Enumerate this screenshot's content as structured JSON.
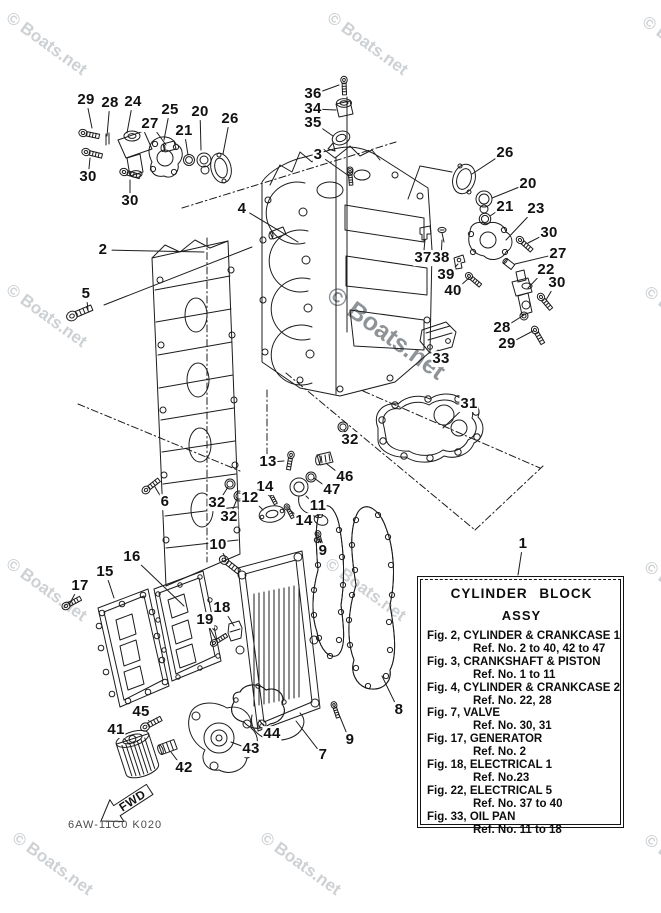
{
  "page": {
    "background": "#ffffff",
    "ink": "#1c1c1c"
  },
  "watermark": {
    "text": "© Boats.net",
    "light_color": "#cdd1d4",
    "dark_color": "#8e9397",
    "angle_deg": 36,
    "tiles": [
      {
        "x": 14,
        "y": 8,
        "size": 17,
        "tone": "light"
      },
      {
        "x": 335,
        "y": 8,
        "size": 17,
        "tone": "light"
      },
      {
        "x": 650,
        "y": 12,
        "size": 17,
        "tone": "light"
      },
      {
        "x": 14,
        "y": 280,
        "size": 17,
        "tone": "light"
      },
      {
        "x": 338,
        "y": 281,
        "size": 25,
        "tone": "dark"
      },
      {
        "x": 652,
        "y": 282,
        "size": 17,
        "tone": "light"
      },
      {
        "x": 14,
        "y": 554,
        "size": 17,
        "tone": "light"
      },
      {
        "x": 333,
        "y": 554,
        "size": 17,
        "tone": "light"
      },
      {
        "x": 652,
        "y": 557,
        "size": 17,
        "tone": "light"
      },
      {
        "x": 20,
        "y": 828,
        "size": 17,
        "tone": "light"
      },
      {
        "x": 268,
        "y": 828,
        "size": 17,
        "tone": "light"
      },
      {
        "x": 652,
        "y": 830,
        "size": 17,
        "tone": "light"
      }
    ]
  },
  "info_box": {
    "ref_number": "1",
    "title_line1": "CYLINDER BLOCK",
    "title_line2": "ASSY",
    "rows": [
      {
        "fig": "Fig. 2, CYLINDER & CRANKCASE 1",
        "ref": "Ref. No. 2 to 40, 42 to 47"
      },
      {
        "fig": "Fig. 3, CRANKSHAFT & PISTON",
        "ref": "Ref. No. 1 to 11"
      },
      {
        "fig": "Fig. 4, CYLINDER & CRANKCASE 2",
        "ref": "Ref. No. 22, 28"
      },
      {
        "fig": "Fig. 7, VALVE",
        "ref": "Ref. No. 30, 31"
      },
      {
        "fig": "Fig. 17, GENERATOR",
        "ref": "Ref. No. 2"
      },
      {
        "fig": "Fig. 18, ELECTRICAL 1",
        "ref": "Ref. No.23"
      },
      {
        "fig": "Fig. 22, ELECTRICAL 5",
        "ref": "Ref. No. 37 to 40"
      },
      {
        "fig": "Fig. 33, OIL PAN",
        "ref": "Ref. No. 11 to 18"
      }
    ]
  },
  "footer": {
    "drawing_code": "6AW-11C0 K020",
    "fwd_label": "FWD"
  },
  "callouts": [
    {
      "n": "29",
      "x": 86,
      "y": 100,
      "tx": 92,
      "ty": 128
    },
    {
      "n": "28",
      "x": 110,
      "y": 103,
      "tx": 107,
      "ty": 136
    },
    {
      "n": "24",
      "x": 133,
      "y": 102,
      "tx": 127,
      "ty": 133
    },
    {
      "n": "25",
      "x": 170,
      "y": 110,
      "tx": 164,
      "ty": 140
    },
    {
      "n": "27",
      "x": 150,
      "y": 124,
      "tx": 166,
      "ty": 145
    },
    {
      "n": "20",
      "x": 200,
      "y": 112,
      "tx": 201,
      "ty": 150
    },
    {
      "n": "21",
      "x": 184,
      "y": 131,
      "tx": 188,
      "ty": 155
    },
    {
      "n": "26",
      "x": 230,
      "y": 119,
      "tx": 223,
      "ty": 154
    },
    {
      "n": "30",
      "x": 88,
      "y": 177,
      "tx": 90,
      "ty": 158
    },
    {
      "n": "30",
      "x": 130,
      "y": 201,
      "tx": 130,
      "ty": 180
    },
    {
      "n": "2",
      "x": 103,
      "y": 250,
      "tx": 204,
      "ty": 252
    },
    {
      "n": "4",
      "x": 242,
      "y": 209,
      "tx": 298,
      "ty": 242
    },
    {
      "n": "5",
      "x": 86,
      "y": 294,
      "tx": 88,
      "ty": 310
    },
    {
      "n": "36",
      "x": 313,
      "y": 94,
      "tx": 339,
      "ty": 85
    },
    {
      "n": "34",
      "x": 313,
      "y": 109,
      "tx": 336,
      "ty": 110
    },
    {
      "n": "35",
      "x": 313,
      "y": 123,
      "tx": 333,
      "ty": 136
    },
    {
      "n": "3",
      "x": 318,
      "y": 155,
      "tx": 349,
      "ty": 176
    },
    {
      "n": "26",
      "x": 505,
      "y": 153,
      "tx": 472,
      "ty": 174
    },
    {
      "n": "20",
      "x": 528,
      "y": 184,
      "tx": 492,
      "ty": 198
    },
    {
      "n": "21",
      "x": 505,
      "y": 207,
      "tx": 490,
      "ty": 216
    },
    {
      "n": "23",
      "x": 536,
      "y": 209,
      "tx": 506,
      "ty": 240
    },
    {
      "n": "30",
      "x": 549,
      "y": 233,
      "tx": 528,
      "ty": 243
    },
    {
      "n": "27",
      "x": 558,
      "y": 254,
      "tx": 515,
      "ty": 264
    },
    {
      "n": "22",
      "x": 546,
      "y": 270,
      "tx": 528,
      "ty": 288
    },
    {
      "n": "30",
      "x": 557,
      "y": 283,
      "tx": 546,
      "ty": 300
    },
    {
      "n": "37",
      "x": 423,
      "y": 258,
      "tx": 425,
      "ty": 240
    },
    {
      "n": "38",
      "x": 441,
      "y": 258,
      "tx": 442,
      "ty": 240
    },
    {
      "n": "39",
      "x": 446,
      "y": 275,
      "tx": 458,
      "ty": 264
    },
    {
      "n": "40",
      "x": 453,
      "y": 291,
      "tx": 469,
      "ty": 278
    },
    {
      "n": "28",
      "x": 502,
      "y": 328,
      "tx": 524,
      "ty": 315
    },
    {
      "n": "29",
      "x": 507,
      "y": 344,
      "tx": 533,
      "ty": 331
    },
    {
      "n": "33",
      "x": 441,
      "y": 359,
      "tx": 438,
      "ty": 350
    },
    {
      "n": "31",
      "x": 469,
      "y": 404,
      "tx": 443,
      "ty": 428
    },
    {
      "n": "32",
      "x": 350,
      "y": 440,
      "tx": 344,
      "ty": 430
    },
    {
      "n": "13",
      "x": 268,
      "y": 462,
      "tx": 284,
      "ty": 461
    },
    {
      "n": "46",
      "x": 345,
      "y": 477,
      "tx": 327,
      "ty": 464
    },
    {
      "n": "47",
      "x": 332,
      "y": 490,
      "tx": 314,
      "ty": 478
    },
    {
      "n": "11",
      "x": 318,
      "y": 506,
      "tx": 306,
      "ty": 496
    },
    {
      "n": "14",
      "x": 265,
      "y": 487,
      "tx": 270,
      "ty": 494
    },
    {
      "n": "12",
      "x": 250,
      "y": 498,
      "tx": 263,
      "ty": 510
    },
    {
      "n": "32",
      "x": 217,
      "y": 503,
      "tx": 228,
      "ty": 487
    },
    {
      "n": "32",
      "x": 229,
      "y": 517,
      "tx": 237,
      "ty": 499
    },
    {
      "n": "14",
      "x": 304,
      "y": 521,
      "tx": 290,
      "ty": 510
    },
    {
      "n": "10",
      "x": 218,
      "y": 545,
      "tx": 226,
      "ty": 559
    },
    {
      "n": "9",
      "x": 323,
      "y": 551,
      "tx": 320,
      "ty": 540
    },
    {
      "n": "16",
      "x": 132,
      "y": 557,
      "tx": 184,
      "ty": 606
    },
    {
      "n": "15",
      "x": 105,
      "y": 572,
      "tx": 114,
      "ty": 598
    },
    {
      "n": "17",
      "x": 80,
      "y": 586,
      "tx": 70,
      "ty": 603
    },
    {
      "n": "18",
      "x": 222,
      "y": 608,
      "tx": 234,
      "ty": 626
    },
    {
      "n": "19",
      "x": 205,
      "y": 620,
      "tx": 216,
      "ty": 640
    },
    {
      "n": "6",
      "x": 165,
      "y": 502,
      "tx": 155,
      "ty": 487
    },
    {
      "n": "8",
      "x": 399,
      "y": 710,
      "tx": 382,
      "ty": 676
    },
    {
      "n": "9",
      "x": 350,
      "y": 740,
      "tx": 338,
      "ty": 712
    },
    {
      "n": "7",
      "x": 323,
      "y": 755,
      "tx": 296,
      "ty": 721
    },
    {
      "n": "45",
      "x": 141,
      "y": 712,
      "tx": 149,
      "ty": 721
    },
    {
      "n": "41",
      "x": 116,
      "y": 730,
      "tx": 129,
      "ty": 744
    },
    {
      "n": "44",
      "x": 272,
      "y": 734,
      "tx": 259,
      "ty": 720
    },
    {
      "n": "43",
      "x": 251,
      "y": 749,
      "tx": 231,
      "ty": 742
    },
    {
      "n": "42",
      "x": 184,
      "y": 768,
      "tx": 171,
      "ty": 752
    },
    {
      "n": "1",
      "x": 523,
      "y": 544,
      "tx": 518,
      "ty": 575
    }
  ],
  "construction_lines": [
    [
      347,
      97,
      347,
      332
    ],
    [
      104,
      305,
      252,
      247
    ],
    [
      408,
      199,
      420,
      166
    ],
    [
      420,
      166,
      452,
      172
    ]
  ]
}
